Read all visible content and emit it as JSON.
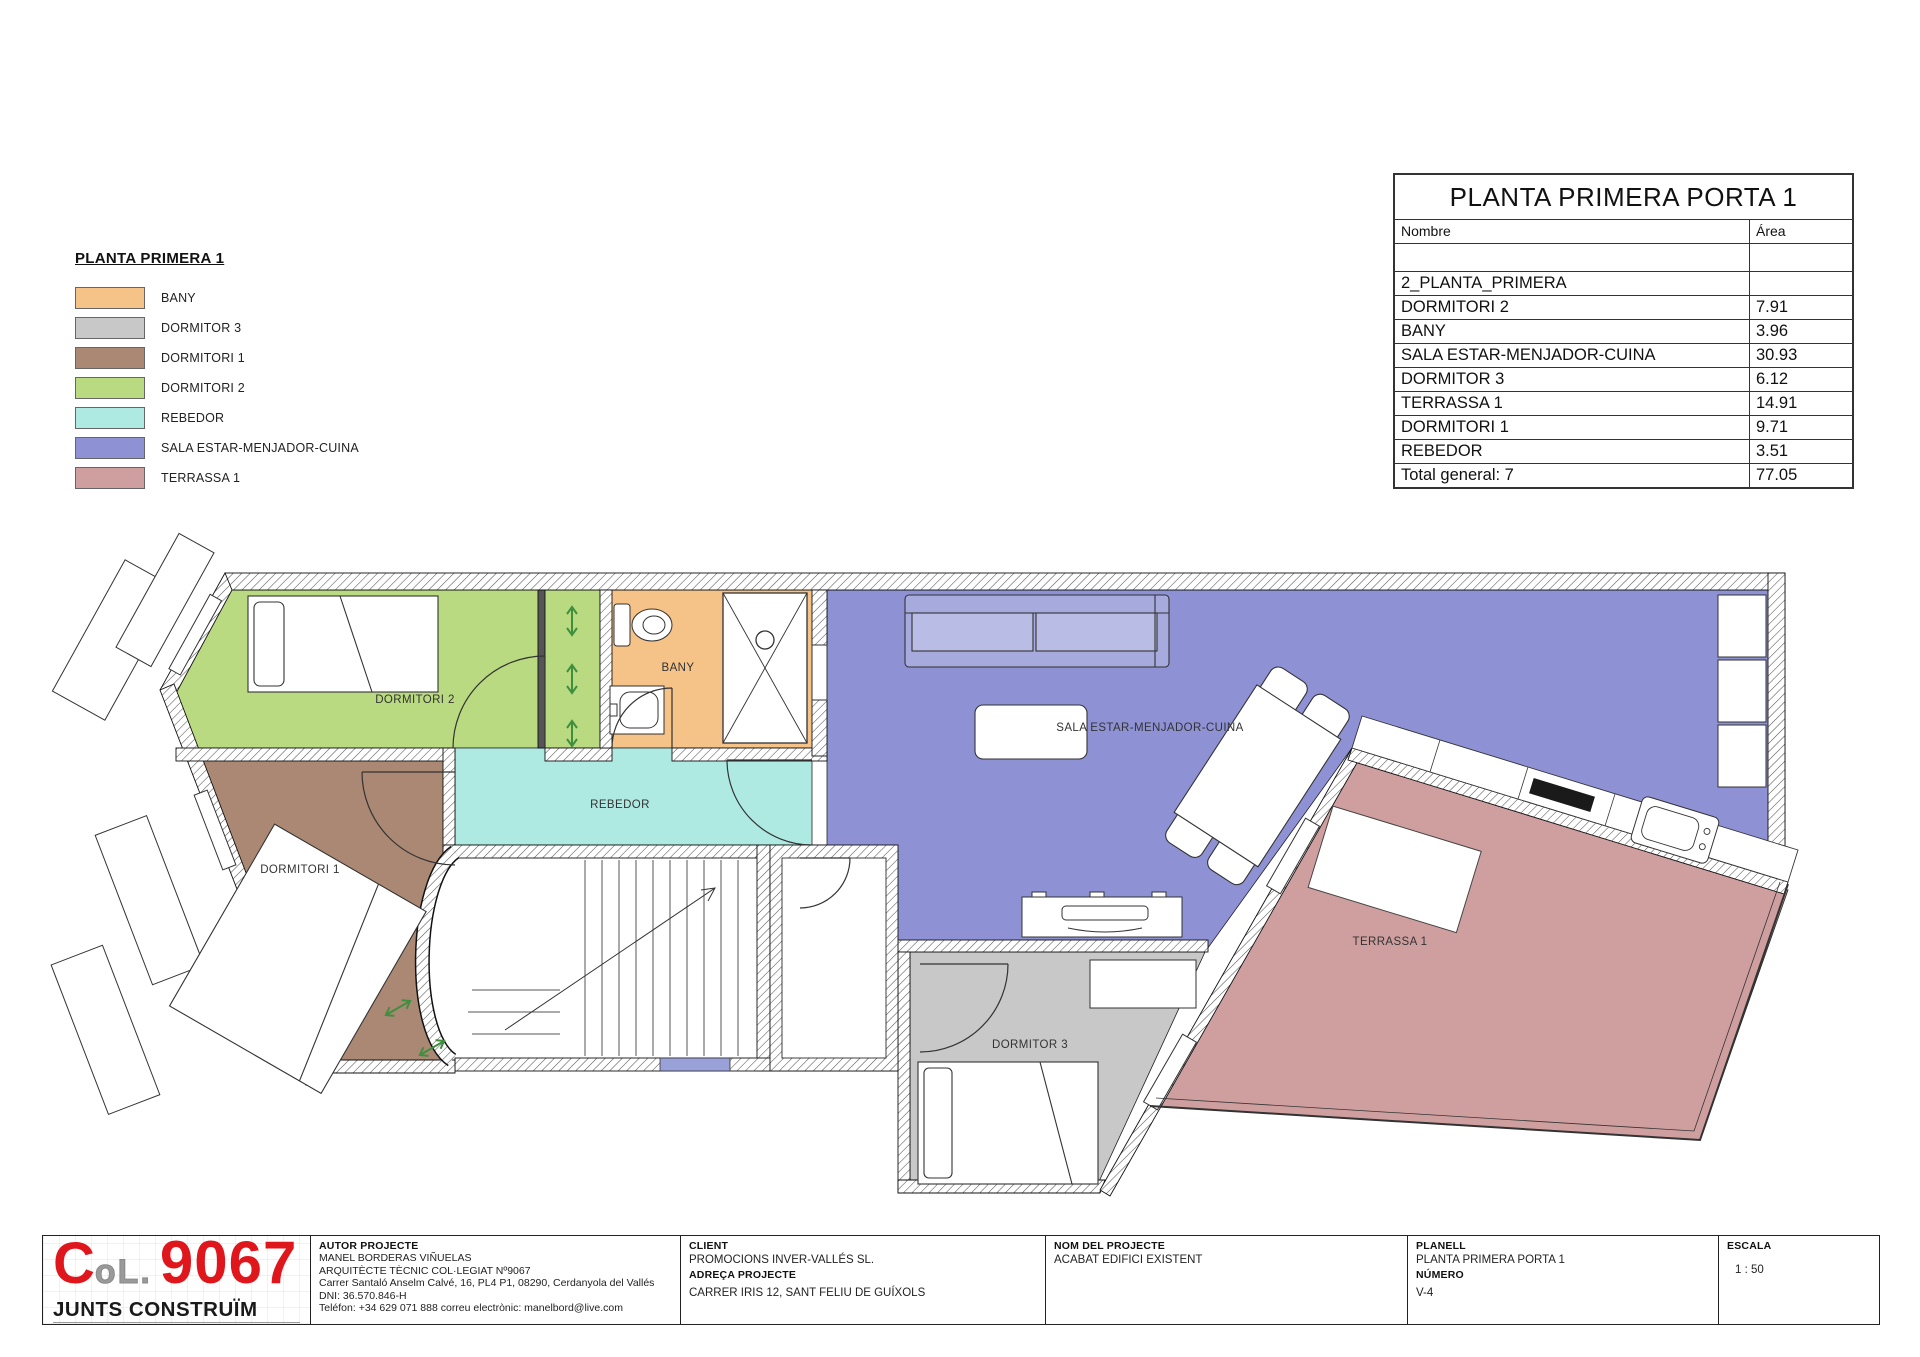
{
  "legend": {
    "title": "PLANTA PRIMERA 1",
    "items": [
      {
        "label": "BANY",
        "color": "#f5c287"
      },
      {
        "label": "DORMITOR 3",
        "color": "#c8c8c8"
      },
      {
        "label": "DORMITORI 1",
        "color": "#ab8874"
      },
      {
        "label": "DORMITORI 2",
        "color": "#b9da80"
      },
      {
        "label": "REBEDOR",
        "color": "#aeeae2"
      },
      {
        "label": "SALA ESTAR-MENJADOR-CUINA",
        "color": "#8e92d4"
      },
      {
        "label": "TERRASSA 1",
        "color": "#cf9fa0"
      }
    ]
  },
  "area_table": {
    "title": "PLANTA PRIMERA PORTA 1",
    "col_nombre": "Nombre",
    "col_area": "Área",
    "group_label": "2_PLANTA_PRIMERA",
    "rows": [
      {
        "nombre": "DORMITORI 2",
        "area": "7.91"
      },
      {
        "nombre": "BANY",
        "area": "3.96"
      },
      {
        "nombre": "SALA ESTAR-MENJADOR-CUINA",
        "area": "30.93"
      },
      {
        "nombre": "DORMITOR 3",
        "area": "6.12"
      },
      {
        "nombre": "TERRASSA 1",
        "area": "14.91"
      },
      {
        "nombre": "DORMITORI 1",
        "area": "9.71"
      },
      {
        "nombre": "REBEDOR",
        "area": "3.51"
      }
    ],
    "total_label": "Total general: 7",
    "total_value": "77.05"
  },
  "title_block": {
    "logo": {
      "letter_c": "C",
      "letters_ol": "oL.",
      "number": "9067",
      "tagline": "JUNTS CONSTRUÏM",
      "red": "#e0161d"
    },
    "autor": {
      "header": "AUTOR PROJECTE",
      "line1": "MANEL BORDERAS VIÑUELAS",
      "line2": "ARQUITÈCTE TÈCNIC COL·LEGIAT Nº9067",
      "line3": "Carrer Santaló Anselm Calvé, 16, PL4 P1, 08290, Cerdanyola del Vallés",
      "line4": "DNI: 36.570.846-H",
      "line5": "Teléfon: +34 629 071 888 correu electrònic: manelbord@live.com"
    },
    "client": {
      "header": "CLIENT",
      "name": "PROMOCIONS INVER-VALLÉS SL.",
      "header2": "ADREÇA PROJECTE",
      "address": "CARRER IRIS 12, SANT FELIU DE GUÍXOLS"
    },
    "projecte": {
      "header": "NOM DEL PROJECTE",
      "name": "ACABAT EDIFICI EXISTENT"
    },
    "planell": {
      "header": "PLANELL",
      "name": "PLANTA PRIMERA PORTA 1",
      "header2": "NÚMERO",
      "number": "V-4"
    },
    "escala": {
      "header": "ESCALA",
      "value": "1 : 50"
    }
  }
}
